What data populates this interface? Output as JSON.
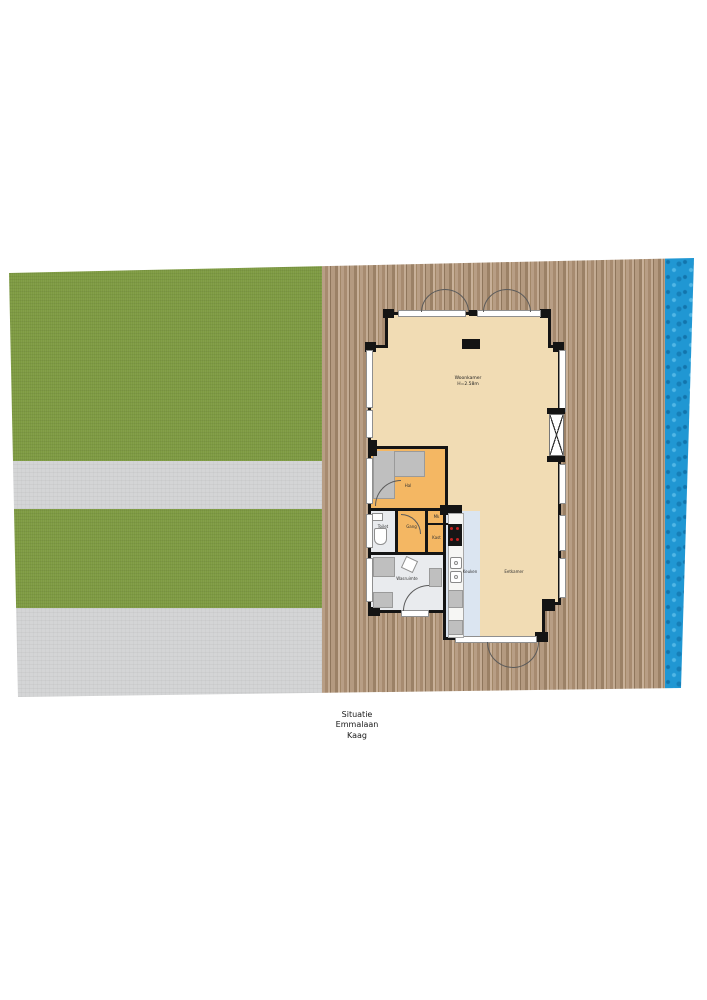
{
  "drawing": {
    "type": "site-plan-floorplan",
    "caption": {
      "line1": "Situatie",
      "line2": "Emmalaan",
      "line3": "Kaag"
    }
  },
  "rooms": {
    "woonkamer": {
      "label": "Woonkamer",
      "height_note": "H=2.58m"
    },
    "hal": {
      "label": "Hal"
    },
    "gang": {
      "label": "Gang"
    },
    "toilet": {
      "label": "Toilet"
    },
    "mk": {
      "label": "Mk"
    },
    "kast": {
      "label": "Kast"
    },
    "wasruimte": {
      "label": "Wasruimte"
    },
    "keuken": {
      "label": "Keuken"
    },
    "eetkamer": {
      "label": "Eetkamer"
    }
  },
  "site_colors": {
    "grass": "#7d9a41",
    "path": "#d4d5d6",
    "deck_wood": "#ab9176",
    "water": "#2097d3",
    "floor_living": "#f1dcb4",
    "floor_hall": "#f4b763",
    "floor_kitchen": "#dbe5f1",
    "floor_utility": "#e9ebee",
    "walls": "#141414"
  }
}
